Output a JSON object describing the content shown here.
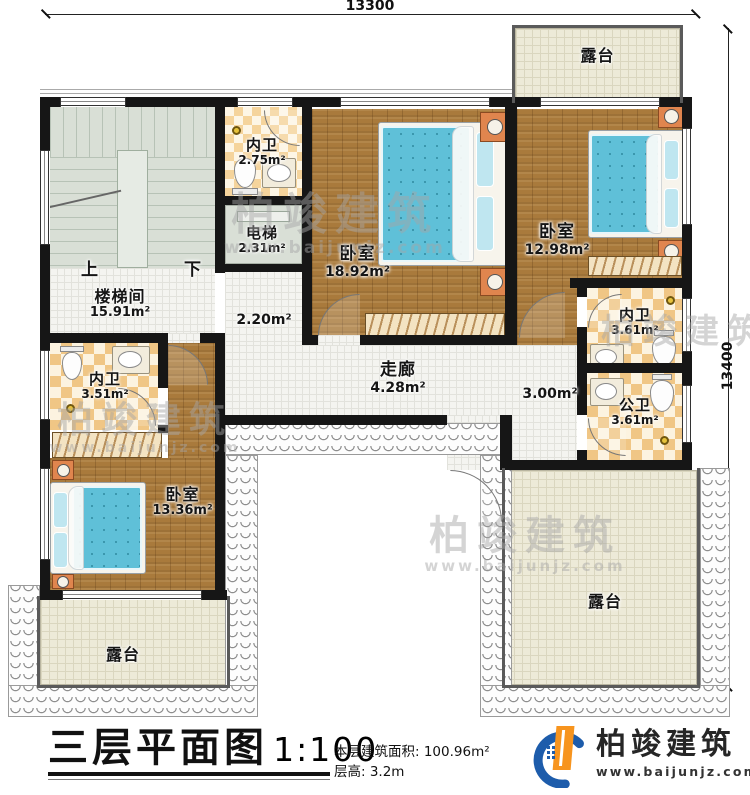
{
  "dims": {
    "top": "13300",
    "right": "13400"
  },
  "rooms": {
    "terrace_top": {
      "name": "露台"
    },
    "bath_top": {
      "name": "内卫",
      "area": "2.75m²"
    },
    "elevator": {
      "name": "电梯",
      "area": "2.31m²"
    },
    "bedroom_main": {
      "name": "卧室",
      "area": "18.92m²"
    },
    "bedroom_right": {
      "name": "卧室",
      "area": "12.98m²"
    },
    "stairwell": {
      "name": "楼梯间",
      "area": "15.91m²",
      "up": "上",
      "down": "下"
    },
    "lobby": {
      "area": "2.20m²"
    },
    "corridor": {
      "name": "走廊",
      "area": "4.28m²"
    },
    "hall": {
      "area": "3.00m²"
    },
    "bath_right": {
      "name": "内卫",
      "area": "3.61m²"
    },
    "bath_public": {
      "name": "公卫",
      "area": "3.61m²"
    },
    "bath_left": {
      "name": "内卫",
      "area": "3.51m²"
    },
    "bedroom_left": {
      "name": "卧室",
      "area": "13.36m²"
    },
    "terrace_left": {
      "name": "露台"
    },
    "terrace_right": {
      "name": "露台"
    }
  },
  "footer": {
    "title": "三层平面图",
    "scale": "1:100",
    "area_info": "本层建筑面积: 100.96m²",
    "height_info": "层高: 3.2m"
  },
  "logo": {
    "brand": "柏竣建筑",
    "url": "www.baijunjz.com"
  },
  "watermark": {
    "brand": "柏竣建筑",
    "url": "www.baijunjz.com"
  },
  "colors": {
    "wall": "#161616",
    "wood_floor": "#a97a3c",
    "bed_blue": "#5fc0d8",
    "checker_tan": "#f0c685",
    "terrace_beige": "#edead8",
    "stair_gray": "#d9dfd6",
    "logo_blue": "#1d5cab",
    "logo_orange": "#f7941e"
  }
}
